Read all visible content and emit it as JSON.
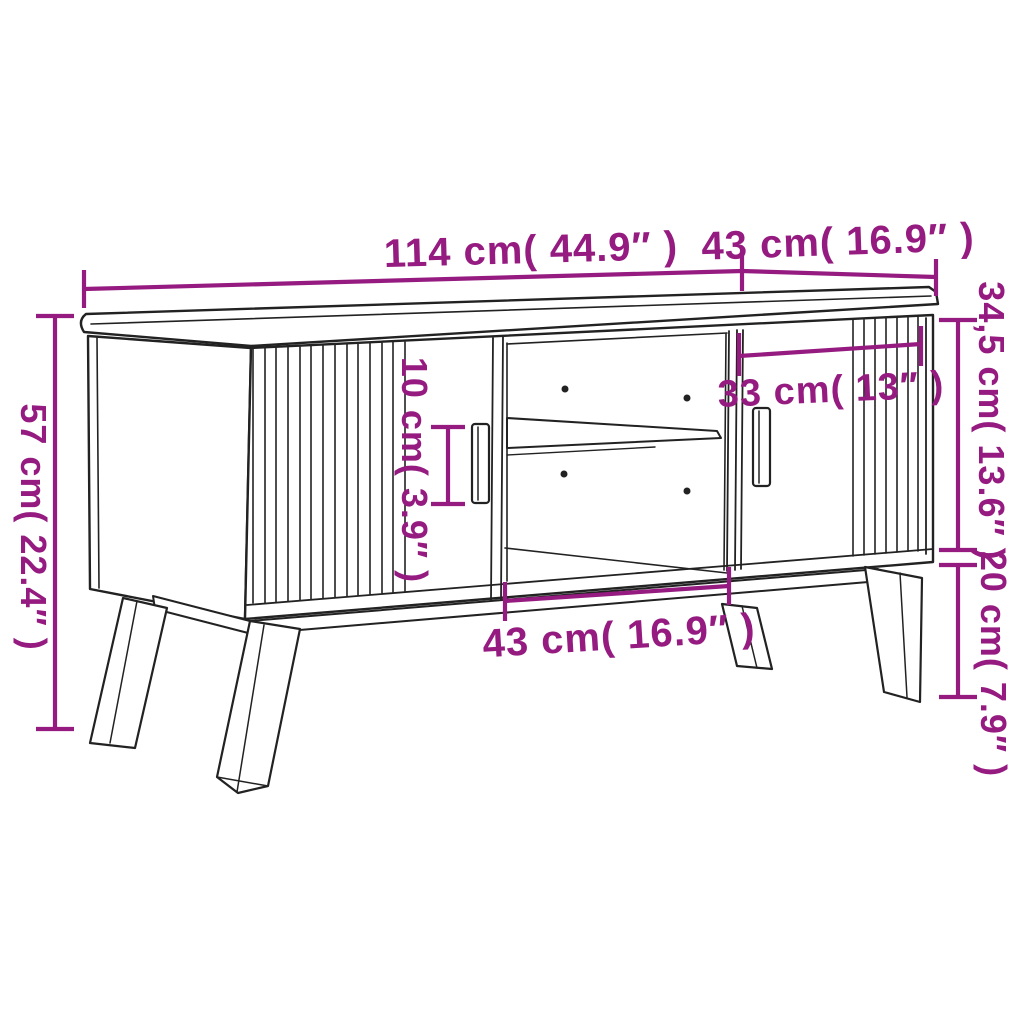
{
  "page": {
    "type": "product-dimension-diagram",
    "product": "TV cabinet with slatted sliding doors, open shelf compartment and splayed legs",
    "background": "#ffffff"
  },
  "colors": {
    "dimension_annotation": "#951b81",
    "line_art": "#222222"
  },
  "dimensions": {
    "top_width": "114 cm( 44.9″ )",
    "top_depth": "43 cm( 16.9″ )",
    "overall_height": "57 cm( 22.4″ )",
    "body_height": "34,5 cm( 13.6″ )",
    "leg_height": "20 cm( 7.9″ )",
    "handle_height": "10 cm( 3.9″ )",
    "door_width": "33 cm( 13″ )",
    "compartment_width": "43 cm( 16.9″ )"
  }
}
